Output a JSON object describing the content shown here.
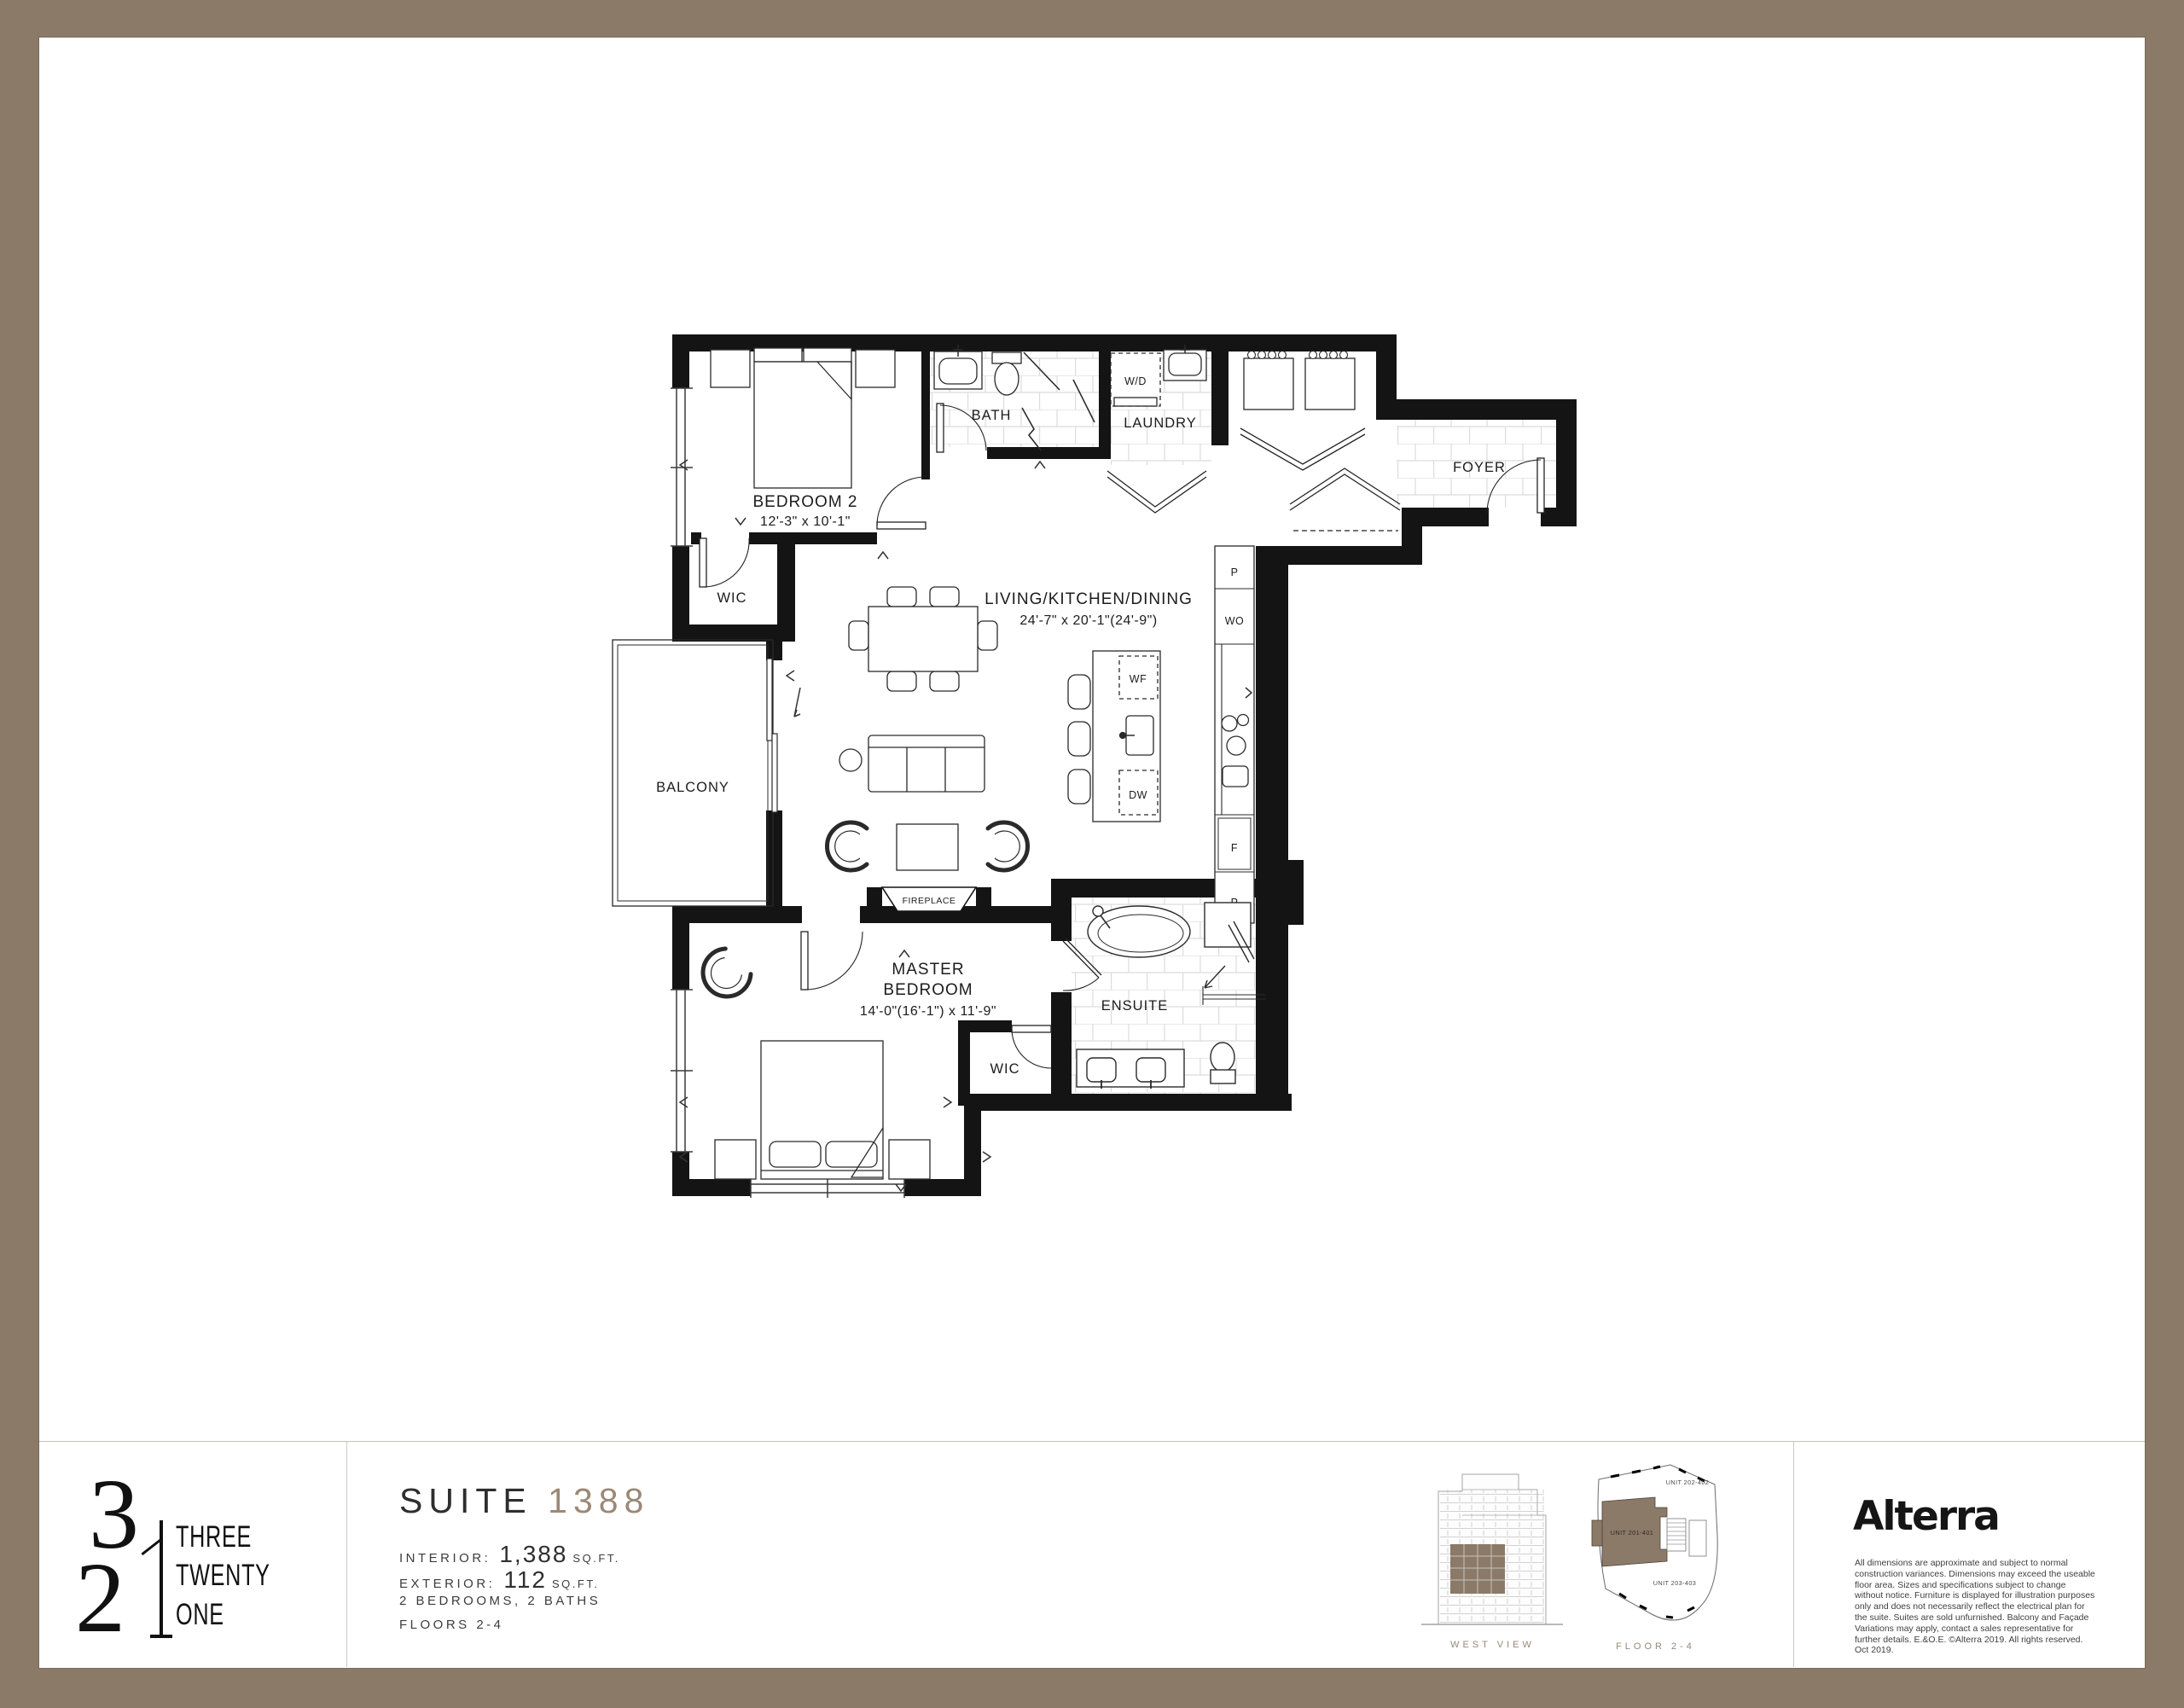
{
  "floorplan": {
    "bedroom2": {
      "name": "BEDROOM 2",
      "dims": "12'-3\" x 10'-1\""
    },
    "wic2": "WIC",
    "bath": "BATH",
    "laundry": "LAUNDRY",
    "wd": "W/D",
    "foyer": "FOYER",
    "living": {
      "name": "LIVING/KITCHEN/DINING",
      "dims": "24'-7\" x 20'-1\"(24'-9\")"
    },
    "balcony": "BALCONY",
    "fireplace": "FIREPLACE",
    "master": {
      "line1": "MASTER",
      "line2": "BEDROOM",
      "dims": "14'-0\"(16'-1\") x 11'-9\""
    },
    "wic_master": "WIC",
    "ensuite": "ENSUITE",
    "kitchen": {
      "pantry_top": "P",
      "wall_oven": "WO",
      "waterfall": "WF",
      "dishwasher": "DW",
      "fridge": "F",
      "pantry_bottom": "P"
    }
  },
  "footer": {
    "logo": {
      "digit3": "3",
      "digit2": "2",
      "words": [
        "THREE",
        "TWENTY",
        "ONE"
      ]
    },
    "suite": {
      "label": "SUITE",
      "number": "1388"
    },
    "details": {
      "interior": {
        "label": "INTERIOR:",
        "value": "1,388",
        "unit": "SQ.FT."
      },
      "exterior": {
        "label": "EXTERIOR:",
        "value": "112",
        "unit": "SQ.FT."
      },
      "rooms": "2 BEDROOMS, 2 BATHS",
      "floors": "FLOORS 2-4"
    },
    "west_view": {
      "caption": "WEST VIEW"
    },
    "key_plan": {
      "caption": "FLOOR 2-4",
      "unit_top": "UNIT 202-402",
      "unit_highlight": "UNIT 201-401",
      "unit_bottom": "UNIT 203-403"
    },
    "brand": {
      "name": "Alterra",
      "disclaimer": "All dimensions are approximate and subject to normal construction variances. Dimensions may exceed the useable floor area. Sizes and specifications subject to change without notice. Furniture is displayed for illustration purposes only and does not necessarily reflect the electrical plan for the suite. Suites are sold unfurnished. Balcony and Façade Variations may apply, contact a sales representative for further details. E.&O.E. ©Alterra 2019. All rights reserved. Oct 2019."
    }
  },
  "colors": {
    "frame": "#8b7a68",
    "accent": "#9b8977",
    "wall": "#141414"
  }
}
